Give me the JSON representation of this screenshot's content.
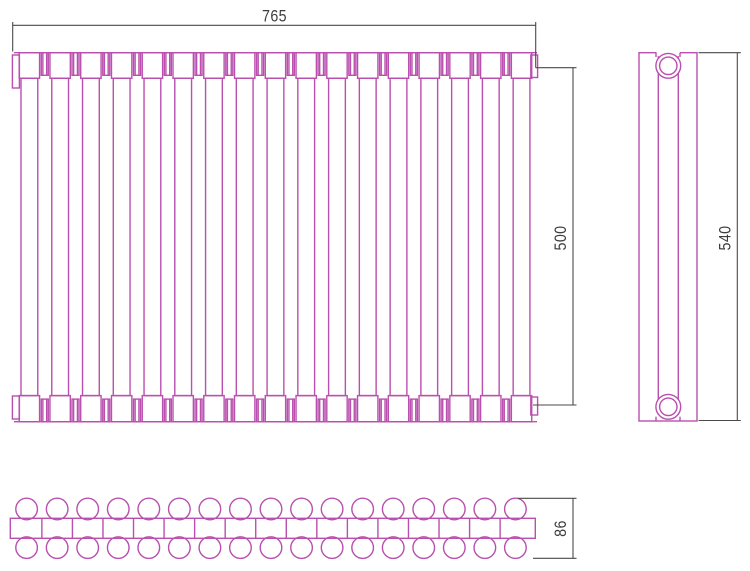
{
  "title": "Tubular radiator dimensional drawing (front, side and top views)",
  "colors": {
    "outline": "#b94fae",
    "dimension_lines": "#4a4a4a",
    "label_text": "#3d3d3d",
    "background": "#ffffff"
  },
  "dimensions": {
    "width": "765",
    "axial_height": "500",
    "overall_height": "540",
    "depth": "86"
  },
  "front_view": {
    "sections": 17
  },
  "top_view": {
    "sections": 17
  }
}
